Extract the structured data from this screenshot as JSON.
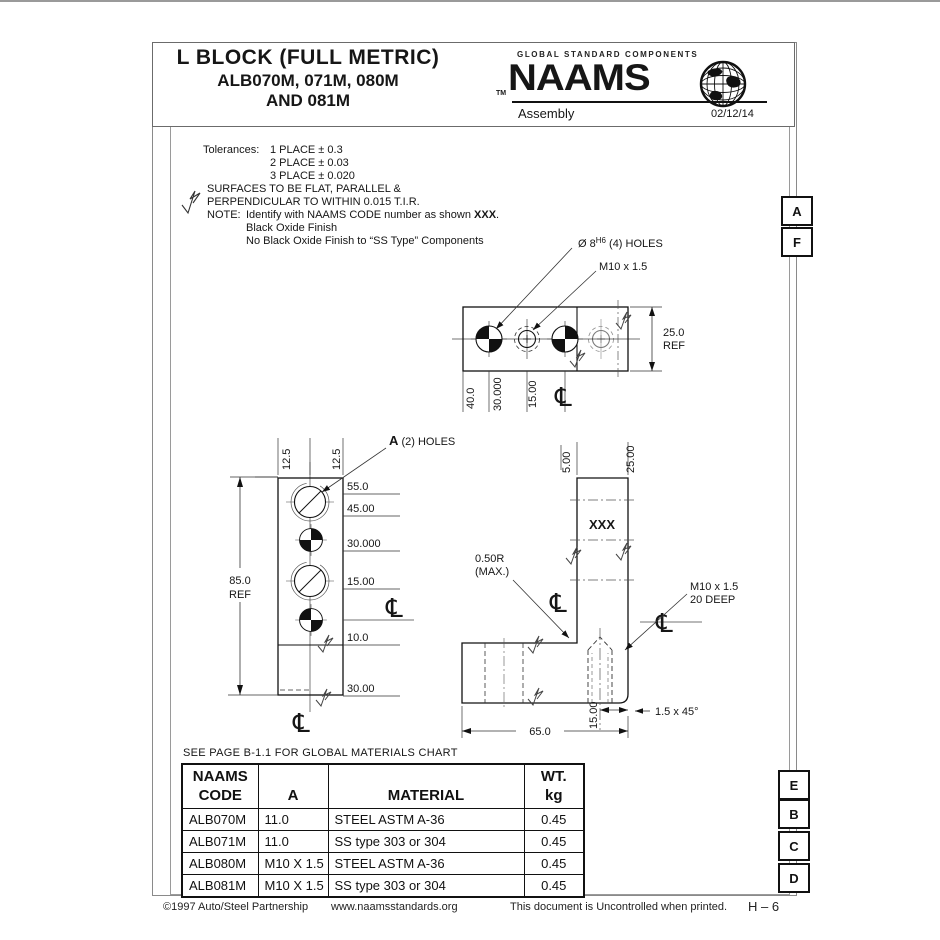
{
  "header": {
    "title_line1": "L BLOCK (FULL METRIC)",
    "title_line2": "ALB070M, 071M, 080M",
    "title_line3": "AND 081M",
    "brand": {
      "tagline": "GLOBAL STANDARD COMPONENTS",
      "tm": "TM",
      "name": "NAAMS",
      "globe_icon": "globe-icon",
      "category": "Assembly",
      "date": "02/12/14"
    }
  },
  "notes": {
    "tolerances_label": "Tolerances:",
    "tol1": "1 PLACE ± 0.3",
    "tol2": "2 PLACE ± 0.03",
    "tol3": "3 PLACE ± 0.020",
    "surfaces1": "SURFACES TO BE FLAT, PARALLEL &",
    "surfaces2": "PERPENDICULAR TO WITHIN 0.015 T.I.R.",
    "note_label": "NOTE:",
    "note1_pre": "Identify with NAAMS CODE number as shown ",
    "note1_bold": "XXX",
    "note1_post": ".",
    "note2": "Black Oxide Finish",
    "note3": "No Black Oxide Finish to “SS Type” Components"
  },
  "drawing": {
    "centerline_symbol": "℄",
    "top_view": {
      "holes_dia_pre": "Ø 8",
      "holes_dia_sup": "H6",
      "holes_dia_post": " (4) HOLES",
      "thread_label": "M10 x 1.5",
      "dim_40": "40.0",
      "dim_30": "30.000",
      "dim_15": "15.00",
      "dim_25": "25.0",
      "ref": "REF"
    },
    "side_view": {
      "a_label_bold": "A",
      "a_label_rest": " (2) HOLES",
      "dim_125_left": "12.5",
      "dim_125_right": "12.5",
      "dim_55": "55.0",
      "dim_45": "45.00",
      "dim_30": "30.000",
      "dim_15": "15.00",
      "dim_10": "10.0",
      "dim_30b": "30.00",
      "dim_85": "85.0",
      "ref": "REF"
    },
    "front_view": {
      "dim_5": "5.00",
      "dim_25": "25.00",
      "marking": "XXX",
      "radius1": "0.50R",
      "radius2": "(MAX.)",
      "thread1": "M10 x 1.5",
      "thread2": "20 DEEP",
      "dim_15": "15.00",
      "dim_65": "65.0",
      "chamfer": "1.5 x 45°"
    }
  },
  "materials_note": "SEE PAGE B-1.1 FOR GLOBAL MATERIALS CHART",
  "table": {
    "headers": {
      "code_line1": "NAAMS",
      "code_line2": "CODE",
      "a": "A",
      "material": "MATERIAL",
      "wt_line1": "WT.",
      "wt_line2": "kg"
    },
    "rows": [
      {
        "code": "ALB070M",
        "a": "11.0",
        "material": "STEEL ASTM A-36",
        "wt": "0.45"
      },
      {
        "code": "ALB071M",
        "a": "11.0",
        "material": "SS type 303 or 304",
        "wt": "0.45"
      },
      {
        "code": "ALB080M",
        "a": "M10 X 1.5",
        "material": "STEEL ASTM A-36",
        "wt": "0.45"
      },
      {
        "code": "ALB081M",
        "a": "M10 X 1.5",
        "material": "SS type 303 or 304",
        "wt": "0.45"
      }
    ]
  },
  "markers": {
    "top": [
      "A",
      "F"
    ],
    "bottom": [
      "E",
      "B",
      "C",
      "D"
    ]
  },
  "footer": {
    "copyright": "©1997 Auto/Steel Partnership",
    "url": "www.naamsstandards.org",
    "uncontrolled": "This document is Uncontrolled when printed.",
    "page_no": "H – 6"
  }
}
